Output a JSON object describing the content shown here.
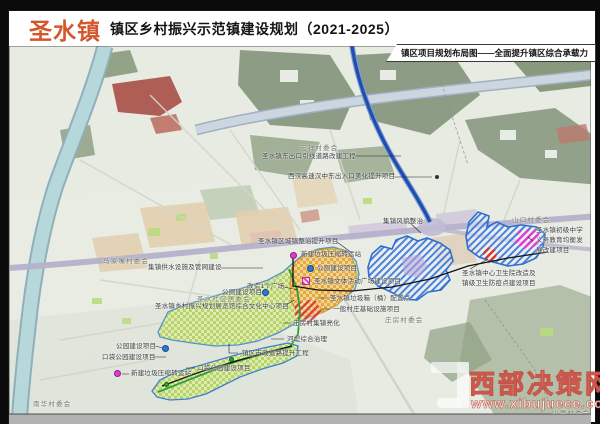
{
  "header": {
    "town": "圣水镇",
    "title": "镇区乡村振兴示范镇建设规划（2021-2025）",
    "map_caption": "镇区项目规划布局图——全面提升镇区综合承载力"
  },
  "watermark": {
    "site": "西部决策网",
    "url": "www.xibujuece.com"
  },
  "colors": {
    "town_orange": "#d4572b",
    "expressway_blue": "#1d4fae",
    "marker_magenta": "#e23bd3",
    "marker_blue": "#2b78d8",
    "marker_green": "#2ba12b",
    "zone_green_fill": "#b9d36c",
    "zone_orange_fill": "#e3a83e",
    "zone_blue_outline": "#2f6fd0"
  },
  "map": {
    "village_labels": [
      {
        "text": "宏祥村委会",
        "x": 300,
        "y": 144
      },
      {
        "text": "马家嘴村委会",
        "x": 103,
        "y": 257
      },
      {
        "text": "圣水社区居委会",
        "x": 197,
        "y": 295
      },
      {
        "text": "庄房村委会",
        "x": 385,
        "y": 316
      },
      {
        "text": "南华村委会",
        "x": 33,
        "y": 400
      },
      {
        "text": "山口村委会",
        "x": 512,
        "y": 216
      },
      {
        "text": "山里村委会",
        "x": 552,
        "y": 409
      }
    ],
    "project_labels": [
      {
        "text": "圣水镇东出口引线道路改建工程",
        "x": 262,
        "y": 152
      },
      {
        "text": "西汉高速汉中东出入口美化提升项目",
        "x": 288,
        "y": 172
      },
      {
        "text": "集镇风貌整治",
        "x": 383,
        "y": 217
      },
      {
        "text": "圣水镇区城镇整治提升项目",
        "x": 258,
        "y": 237
      },
      {
        "text": "新建垃圾压缩转运站",
        "x": 301,
        "y": 250
      },
      {
        "text": "集镇供水设施及管网建设",
        "x": 148,
        "y": 263
      },
      {
        "text": "公厕建设项目",
        "x": 317,
        "y": 264
      },
      {
        "text": "圣水镇文体活动广场建设项目",
        "x": 314,
        "y": 277
      },
      {
        "text": "改造1个广场",
        "x": 247,
        "y": 282
      },
      {
        "text": "公厕建设项目",
        "x": 222,
        "y": 288
      },
      {
        "text": "圣水镇乡村振兴规划展览馆综合文化中心项目",
        "x": 155,
        "y": 302
      },
      {
        "text": "圣水镇垃圾箱（桶）配置点",
        "x": 330,
        "y": 294
      },
      {
        "text": "一般村庄基础设施项目",
        "x": 333,
        "y": 305
      },
      {
        "text": "庄房村集镇亮化",
        "x": 293,
        "y": 319
      },
      {
        "text": "河堤综合治理",
        "x": 287,
        "y": 335
      },
      {
        "text": "镇区市政道路提升工程",
        "x": 242,
        "y": 349
      },
      {
        "text": "公园建设项目",
        "x": 116,
        "y": 342
      },
      {
        "text": "口袋公园建设项目",
        "x": 102,
        "y": 353
      },
      {
        "text": "口袋公园建设项目",
        "x": 197,
        "y": 364
      },
      {
        "text": "新建垃圾压缩转运站",
        "x": 131,
        "y": 369
      },
      {
        "text": "圣水镇初级中学\n义务教育均衡发\n展改建项目",
        "x": 536,
        "y": 226
      },
      {
        "text": "圣水镇中心卫生院改造及\n镇级卫生防疫点建设项目",
        "x": 462,
        "y": 269
      }
    ],
    "markers": [
      {
        "type": "dot-magenta",
        "x": 293,
        "y": 255
      },
      {
        "type": "dot-magenta",
        "x": 117,
        "y": 373
      },
      {
        "type": "dot-blue",
        "x": 310,
        "y": 268
      },
      {
        "type": "dot-blue",
        "x": 265,
        "y": 292
      },
      {
        "type": "dot-blue",
        "x": 165,
        "y": 348
      },
      {
        "type": "dot-green",
        "x": 231,
        "y": 359
      },
      {
        "type": "dot-green",
        "x": 166,
        "y": 384
      },
      {
        "type": "square-magenta",
        "x": 306,
        "y": 281
      },
      {
        "type": "dot-dark",
        "x": 437,
        "y": 177
      }
    ]
  }
}
